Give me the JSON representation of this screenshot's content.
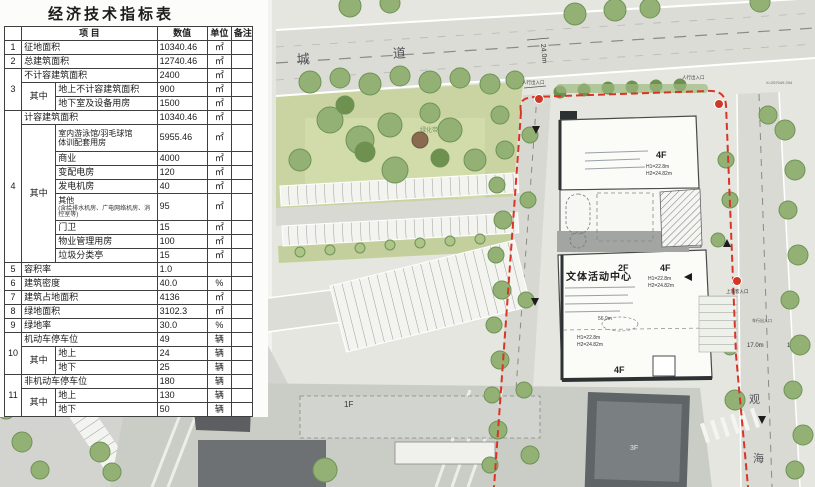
{
  "table": {
    "title": "经济技术指标表",
    "header": {
      "item": "项 目",
      "value": "数值",
      "unit": "单位",
      "remark": "备注"
    },
    "qizhong": "其中",
    "rows": {
      "r1": {
        "no": "1",
        "label": "征地面积",
        "value": "10340.46",
        "unit": "㎡"
      },
      "r2": {
        "no": "2",
        "label": "总建筑面积",
        "value": "12740.46",
        "unit": "㎡"
      },
      "r3": {
        "no": "3",
        "label": "不计容建筑面积",
        "value": "2400",
        "unit": "㎡"
      },
      "r3a": {
        "label": "地上不计容建筑面积",
        "value": "900",
        "unit": "㎡"
      },
      "r3b": {
        "label": "地下室及设备用房",
        "value": "1500",
        "unit": "㎡"
      },
      "r4": {
        "no": "4",
        "label": "计容建筑面积",
        "value": "10340.46",
        "unit": "㎡"
      },
      "r4a": {
        "label1": "室内游泳馆/羽毛球馆",
        "label2": "体训配套用房",
        "value": "5955.46",
        "unit": "㎡"
      },
      "r4b": {
        "label": "商业",
        "value": "4000",
        "unit": "㎡"
      },
      "r4c": {
        "label": "变配电房",
        "value": "120",
        "unit": "㎡"
      },
      "r4d": {
        "label": "发电机房",
        "value": "40",
        "unit": "㎡"
      },
      "r4e": {
        "label": "其他",
        "note": "(含给排水机房、广电网络机房、消控室等)",
        "value": "95",
        "unit": "㎡"
      },
      "r4f": {
        "label": "门卫",
        "value": "15",
        "unit": "㎡"
      },
      "r4g": {
        "label": "物业管理用房",
        "value": "100",
        "unit": "㎡"
      },
      "r4h": {
        "label": "垃圾分类亭",
        "value": "15",
        "unit": "㎡"
      },
      "r5": {
        "no": "5",
        "label": "容积率",
        "value": "1.0",
        "unit": ""
      },
      "r6": {
        "no": "6",
        "label": "建筑密度",
        "value": "40.0",
        "unit": "%"
      },
      "r7": {
        "no": "7",
        "label": "建筑占地面积",
        "value": "4136",
        "unit": "㎡"
      },
      "r8": {
        "no": "8",
        "label": "绿地面积",
        "value": "3102.3",
        "unit": "㎡"
      },
      "r9": {
        "no": "9",
        "label": "绿地率",
        "value": "30.0",
        "unit": "%"
      },
      "r10": {
        "no": "10",
        "label": "机动车停车位",
        "value": "49",
        "unit": "辆"
      },
      "r10a": {
        "label": "地上",
        "value": "24",
        "unit": "辆"
      },
      "r10b": {
        "label": "地下",
        "value": "25",
        "unit": "辆"
      },
      "r11": {
        "no": "11",
        "label": "非机动车停车位",
        "value": "180",
        "unit": "辆"
      },
      "r11a": {
        "label": "地上",
        "value": "130",
        "unit": "辆"
      },
      "r11b": {
        "label": "地下",
        "value": "50",
        "unit": "辆"
      }
    }
  },
  "map": {
    "building_name": "文体活动中心",
    "floors": {
      "f1": "1F",
      "f2": "2F",
      "f3": "3F",
      "f4": "4F"
    },
    "heights": {
      "h1": "H1=22.8m",
      "h2": "H2=24.82m"
    },
    "roads": {
      "top_char_a": "城",
      "top_char_b": "道",
      "right_char_a": "观",
      "right_char_b": "海"
    },
    "dims": {
      "d24": "24.0m",
      "d56": "56.0m",
      "d56_9": "56.9m",
      "d17": "17.0m",
      "d12": "12.0m",
      "d24_4": "24.4m"
    },
    "annotations": {
      "green_belt": "绿化带",
      "ped_entrance": "人行出入口",
      "vehicle_entrance": "车行出入口",
      "dropoff_entrance": "上落客入口",
      "coord_x": "X=257049.204"
    },
    "colors": {
      "boundary_red": "#d93526"
    }
  }
}
